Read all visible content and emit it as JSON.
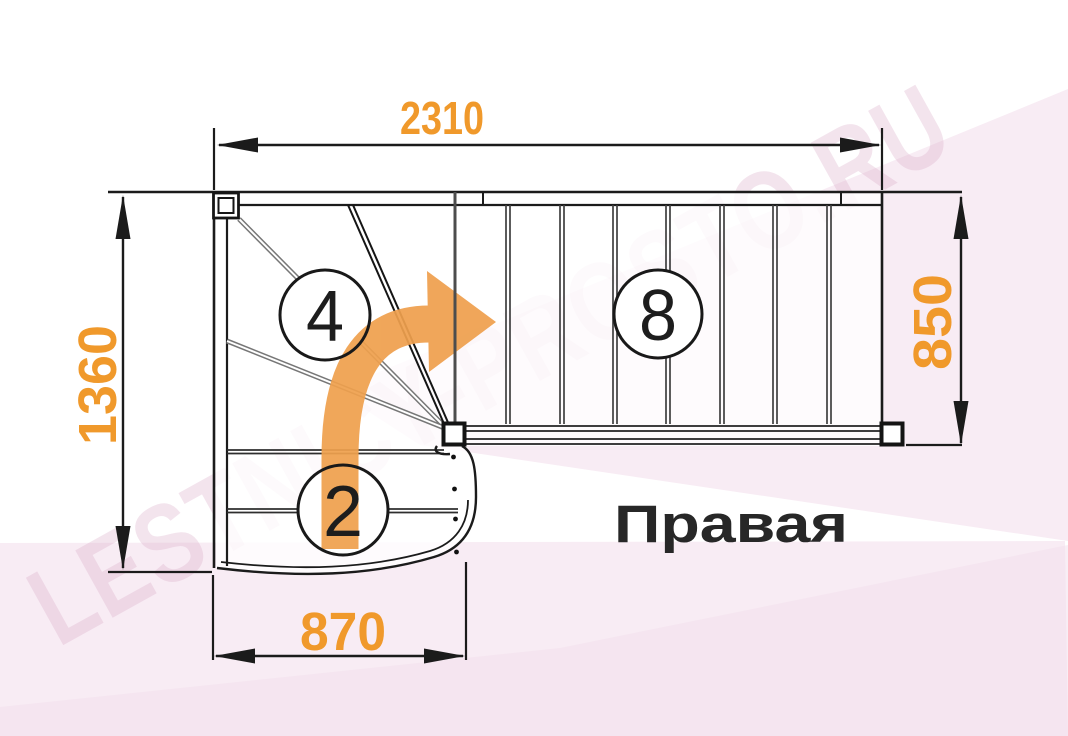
{
  "diagram": {
    "orientation_label": "Правая",
    "watermark": "LESTNICY-PROSTO.RU",
    "dimensions": {
      "top_width": "2310",
      "left_height": "1360",
      "right_flight_height": "850",
      "bottom_width": "870"
    },
    "step_labels": {
      "winders": "4",
      "bottom_steps": "2",
      "straight_steps": "8"
    },
    "colors": {
      "dimension_text": "#F0992B",
      "arrow": "#EFA04E",
      "lines": "#1B1B1B",
      "background_tint": "#F8ECF4",
      "watermark_text": "#D9A8C6"
    }
  }
}
